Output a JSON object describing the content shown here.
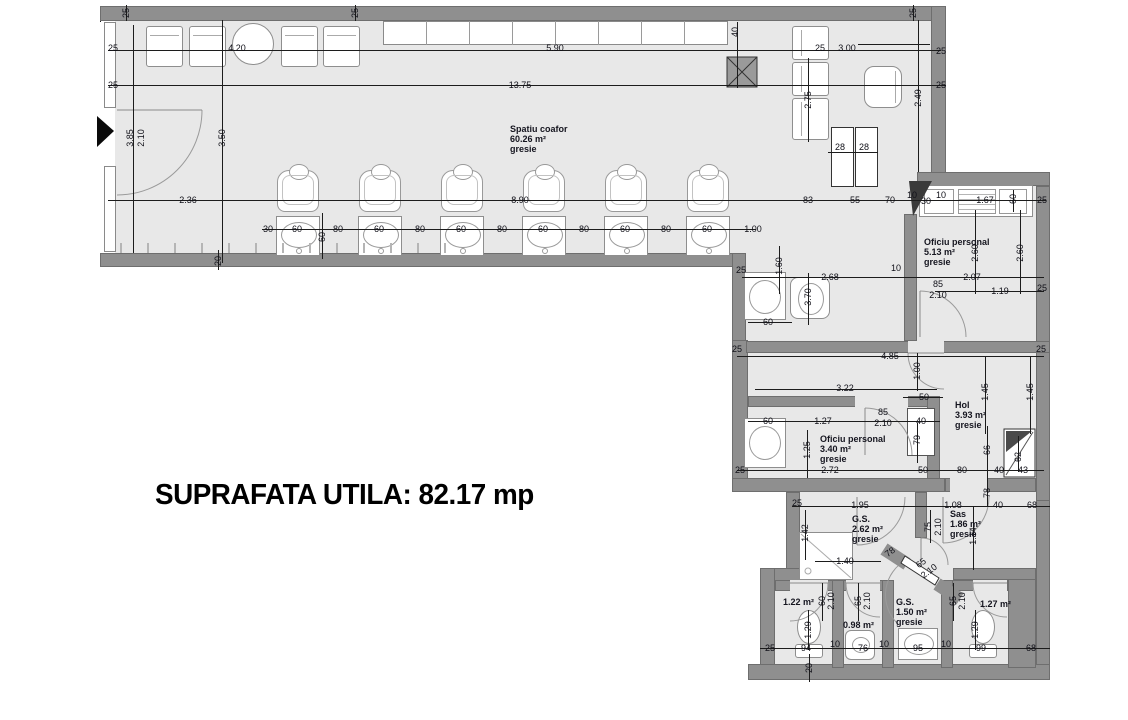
{
  "title": "SUPRAFATA UTILA: 82.17 mp",
  "rooms": [
    {
      "name": "Spatiu coafor",
      "area": "60.26 m²",
      "floor": "gresie",
      "x": 510,
      "y": 124
    },
    {
      "name": "Oficiu personal",
      "area": "5.13 m²",
      "floor": "gresie",
      "x": 924,
      "y": 237
    },
    {
      "name": "Oficiu personal",
      "area": "3.40 m²",
      "floor": "gresie",
      "x": 820,
      "y": 434
    },
    {
      "name": "Hol",
      "area": "3.93 m²",
      "floor": "gresie",
      "x": 955,
      "y": 400
    },
    {
      "name": "G.S.",
      "area": "2.62 m²",
      "floor": "gresie",
      "x": 852,
      "y": 514
    },
    {
      "name": "Sas",
      "area": "1.86 m²",
      "floor": "gresie",
      "x": 950,
      "y": 509
    },
    {
      "name": "G.S.",
      "area": "1.50 m²",
      "floor": "gresie",
      "x": 896,
      "y": 597
    },
    {
      "name": "",
      "area": "1.22 m²",
      "floor": "",
      "x": 783,
      "y": 597
    },
    {
      "name": "",
      "area": "0.98 m²",
      "floor": "",
      "x": 843,
      "y": 620
    },
    {
      "name": "",
      "area": "1.27 m²",
      "floor": "",
      "x": 980,
      "y": 599
    }
  ],
  "dims": [
    {
      "t": "25",
      "x": 126,
      "y": 13,
      "o": "v"
    },
    {
      "t": "25",
      "x": 113,
      "y": 48
    },
    {
      "t": "25",
      "x": 113,
      "y": 85
    },
    {
      "t": "4.20",
      "x": 237,
      "y": 48
    },
    {
      "t": "25",
      "x": 355,
      "y": 13,
      "o": "v"
    },
    {
      "t": "5.90",
      "x": 555,
      "y": 48
    },
    {
      "t": "13.75",
      "x": 520,
      "y": 85
    },
    {
      "t": "40",
      "x": 735,
      "y": 32,
      "o": "v"
    },
    {
      "t": "25",
      "x": 820,
      "y": 48
    },
    {
      "t": "3.00",
      "x": 847,
      "y": 48
    },
    {
      "t": "25",
      "x": 913,
      "y": 13,
      "o": "v"
    },
    {
      "t": "25",
      "x": 941,
      "y": 51
    },
    {
      "t": "25",
      "x": 941,
      "y": 85
    },
    {
      "t": "2.49",
      "x": 918,
      "y": 98,
      "o": "v"
    },
    {
      "t": "2.75",
      "x": 808,
      "y": 100,
      "o": "v"
    },
    {
      "t": "28",
      "x": 840,
      "y": 147
    },
    {
      "t": "28",
      "x": 864,
      "y": 147
    },
    {
      "t": "3.85",
      "x": 130,
      "y": 138,
      "o": "v"
    },
    {
      "t": "2.10",
      "x": 141,
      "y": 138,
      "o": "v"
    },
    {
      "t": "3.50",
      "x": 222,
      "y": 138,
      "o": "v"
    },
    {
      "t": "2.36",
      "x": 188,
      "y": 200
    },
    {
      "t": "8.90",
      "x": 520,
      "y": 200
    },
    {
      "t": "83",
      "x": 808,
      "y": 200
    },
    {
      "t": "55",
      "x": 855,
      "y": 200
    },
    {
      "t": "70",
      "x": 890,
      "y": 200
    },
    {
      "t": "10",
      "x": 912,
      "y": 195
    },
    {
      "t": "30",
      "x": 926,
      "y": 201
    },
    {
      "t": "10",
      "x": 941,
      "y": 195
    },
    {
      "t": "1.67",
      "x": 985,
      "y": 200
    },
    {
      "t": "60",
      "x": 1013,
      "y": 199,
      "o": "v"
    },
    {
      "t": "25",
      "x": 1042,
      "y": 200
    },
    {
      "t": "20",
      "x": 218,
      "y": 261,
      "o": "v"
    },
    {
      "t": "30",
      "x": 268,
      "y": 229
    },
    {
      "t": "60",
      "x": 297,
      "y": 229
    },
    {
      "t": "80",
      "x": 338,
      "y": 229
    },
    {
      "t": "60",
      "x": 379,
      "y": 229
    },
    {
      "t": "80",
      "x": 420,
      "y": 229
    },
    {
      "t": "60",
      "x": 461,
      "y": 229
    },
    {
      "t": "80",
      "x": 502,
      "y": 229
    },
    {
      "t": "60",
      "x": 543,
      "y": 229
    },
    {
      "t": "80",
      "x": 584,
      "y": 229
    },
    {
      "t": "60",
      "x": 625,
      "y": 229
    },
    {
      "t": "80",
      "x": 666,
      "y": 229
    },
    {
      "t": "60",
      "x": 707,
      "y": 229
    },
    {
      "t": "1.00",
      "x": 753,
      "y": 229
    },
    {
      "t": "60",
      "x": 322,
      "y": 237,
      "o": "v"
    },
    {
      "t": "1.60",
      "x": 779,
      "y": 266,
      "o": "v"
    },
    {
      "t": "25",
      "x": 741,
      "y": 270
    },
    {
      "t": "2.68",
      "x": 830,
      "y": 277
    },
    {
      "t": "3.70",
      "x": 808,
      "y": 297,
      "o": "v"
    },
    {
      "t": "60",
      "x": 768,
      "y": 322
    },
    {
      "t": "10",
      "x": 896,
      "y": 268
    },
    {
      "t": "2.60",
      "x": 975,
      "y": 253,
      "o": "v"
    },
    {
      "t": "2.60",
      "x": 1020,
      "y": 253,
      "o": "v"
    },
    {
      "t": "2.07",
      "x": 972,
      "y": 277
    },
    {
      "t": "85",
      "x": 938,
      "y": 284
    },
    {
      "t": "2.10",
      "x": 938,
      "y": 295
    },
    {
      "t": "1.19",
      "x": 1000,
      "y": 291
    },
    {
      "t": "25",
      "x": 1042,
      "y": 288
    },
    {
      "t": "25",
      "x": 737,
      "y": 349
    },
    {
      "t": "25",
      "x": 1041,
      "y": 349
    },
    {
      "t": "4.85",
      "x": 890,
      "y": 356
    },
    {
      "t": "1.00",
      "x": 917,
      "y": 371,
      "o": "v"
    },
    {
      "t": "3.22",
      "x": 845,
      "y": 388
    },
    {
      "t": "50",
      "x": 924,
      "y": 397
    },
    {
      "t": "1.45",
      "x": 985,
      "y": 392,
      "o": "v"
    },
    {
      "t": "1.45",
      "x": 1030,
      "y": 392,
      "o": "v"
    },
    {
      "t": "60",
      "x": 768,
      "y": 421
    },
    {
      "t": "1.27",
      "x": 823,
      "y": 421
    },
    {
      "t": "85",
      "x": 883,
      "y": 412
    },
    {
      "t": "2.10",
      "x": 883,
      "y": 423
    },
    {
      "t": "40",
      "x": 921,
      "y": 421
    },
    {
      "t": "79",
      "x": 917,
      "y": 440,
      "o": "v"
    },
    {
      "t": "1.25",
      "x": 807,
      "y": 450,
      "o": "v"
    },
    {
      "t": "66",
      "x": 987,
      "y": 450,
      "o": "v"
    },
    {
      "t": "62",
      "x": 1018,
      "y": 457,
      "o": "v"
    },
    {
      "t": "25",
      "x": 740,
      "y": 470
    },
    {
      "t": "2.72",
      "x": 830,
      "y": 470
    },
    {
      "t": "50",
      "x": 923,
      "y": 470
    },
    {
      "t": "80",
      "x": 962,
      "y": 470
    },
    {
      "t": "40",
      "x": 999,
      "y": 470
    },
    {
      "t": "43",
      "x": 1023,
      "y": 470
    },
    {
      "t": "78",
      "x": 987,
      "y": 493,
      "o": "v"
    },
    {
      "t": "25",
      "x": 797,
      "y": 503
    },
    {
      "t": "1.95",
      "x": 860,
      "y": 505
    },
    {
      "t": "1.08",
      "x": 953,
      "y": 505
    },
    {
      "t": "40",
      "x": 998,
      "y": 505
    },
    {
      "t": "68",
      "x": 1032,
      "y": 505
    },
    {
      "t": "1.42",
      "x": 805,
      "y": 533,
      "o": "v"
    },
    {
      "t": "75",
      "x": 928,
      "y": 527,
      "o": "v"
    },
    {
      "t": "2.10",
      "x": 938,
      "y": 527,
      "o": "v"
    },
    {
      "t": "1.14",
      "x": 973,
      "y": 536,
      "o": "v"
    },
    {
      "t": "1.40",
      "x": 845,
      "y": 561
    },
    {
      "t": "78",
      "x": 890,
      "y": 552,
      "o": "d"
    },
    {
      "t": "65",
      "x": 921,
      "y": 563,
      "o": "d"
    },
    {
      "t": "2.10",
      "x": 929,
      "y": 571,
      "o": "d"
    },
    {
      "t": "60",
      "x": 822,
      "y": 601,
      "o": "v"
    },
    {
      "t": "2.10",
      "x": 831,
      "y": 601,
      "o": "v"
    },
    {
      "t": "65",
      "x": 858,
      "y": 601,
      "o": "v"
    },
    {
      "t": "2.10",
      "x": 867,
      "y": 601,
      "o": "v"
    },
    {
      "t": "65",
      "x": 953,
      "y": 601,
      "o": "v"
    },
    {
      "t": "2.10",
      "x": 962,
      "y": 601,
      "o": "v"
    },
    {
      "t": "1.29",
      "x": 808,
      "y": 630,
      "o": "v"
    },
    {
      "t": "1.29",
      "x": 975,
      "y": 630,
      "o": "v"
    },
    {
      "t": "25",
      "x": 770,
      "y": 648
    },
    {
      "t": "94",
      "x": 806,
      "y": 648
    },
    {
      "t": "10",
      "x": 835,
      "y": 644
    },
    {
      "t": "76",
      "x": 863,
      "y": 648
    },
    {
      "t": "10",
      "x": 884,
      "y": 644
    },
    {
      "t": "95",
      "x": 918,
      "y": 648
    },
    {
      "t": "10",
      "x": 946,
      "y": 644
    },
    {
      "t": "99",
      "x": 981,
      "y": 648
    },
    {
      "t": "68",
      "x": 1031,
      "y": 648
    },
    {
      "t": "20",
      "x": 809,
      "y": 668,
      "o": "v"
    }
  ]
}
